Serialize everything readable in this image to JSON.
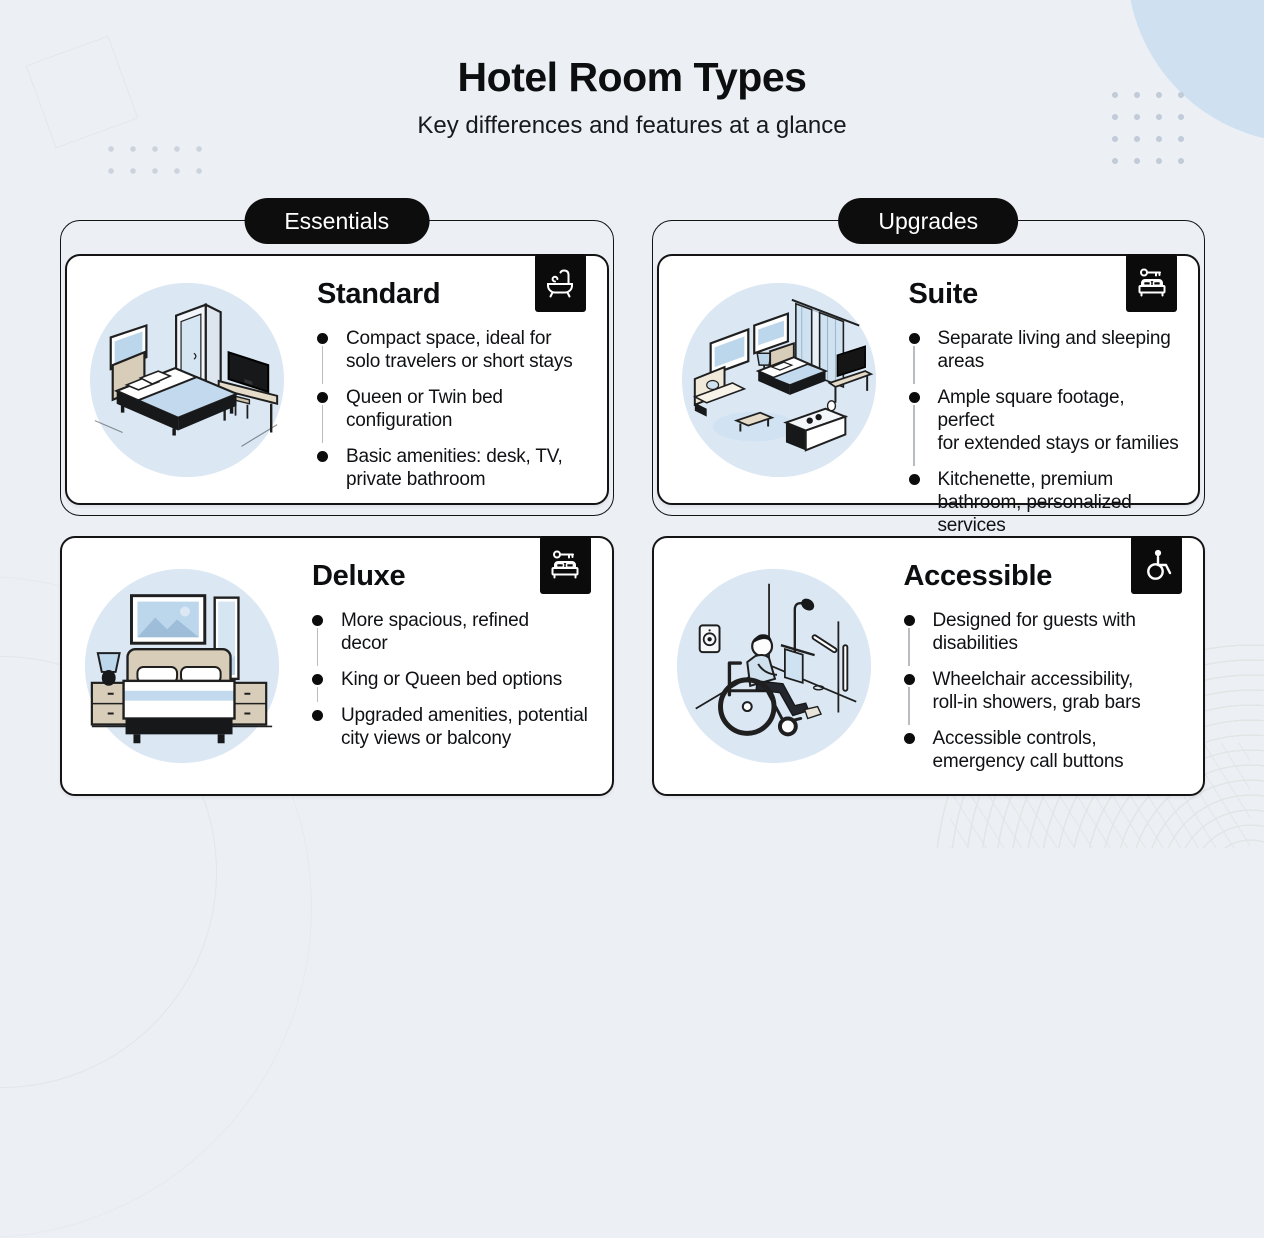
{
  "header": {
    "title": "Hotel Room Types",
    "subtitle": "Key differences and features at a glance"
  },
  "groups": [
    {
      "label": "Essentials"
    },
    {
      "label": "Upgrades"
    }
  ],
  "cards": [
    {
      "id": "standard",
      "title": "Standard",
      "icon": "bathtub-icon",
      "illustration": "isometric-standard-room",
      "bullets": [
        "Compact space, ideal for\nsolo travelers or short stays",
        "Queen or Twin bed\nconfiguration",
        "Basic amenities: desk, TV,\nprivate bathroom"
      ]
    },
    {
      "id": "deluxe",
      "title": "Deluxe",
      "icon": "key-bed-icon",
      "illustration": "deluxe-bedroom",
      "bullets": [
        "More spacious, refined\ndecor",
        "King or Queen bed options",
        "Upgraded amenities, potential\ncity views or balcony"
      ]
    },
    {
      "id": "suite",
      "title": "Suite",
      "icon": "key-bed-icon",
      "illustration": "isometric-suite-room",
      "bullets": [
        "Separate living and sleeping\nareas",
        "Ample square footage, perfect\nfor extended stays or families",
        "Kitchenette, premium\nbathroom, personalized\nservices"
      ]
    },
    {
      "id": "accessible",
      "title": "Accessible",
      "icon": "wheelchair-icon",
      "illustration": "accessible-bathroom",
      "bullets": [
        "Designed for guests with\ndisabilities",
        "Wheelchair accessibility,\nroll-in showers, grab bars",
        "Accessible controls,\nemergency call buttons"
      ]
    }
  ],
  "colors": {
    "page_background": "#ecf0f5",
    "card_background": "#ffffff",
    "border": "#141414",
    "pill_background": "#0d0d0d",
    "pill_text": "#ffffff",
    "badge_background": "#0b0b0b",
    "illustration_circle": "#dbe8f4",
    "accent_light_blue": "#c3d9ee",
    "text": "#101010"
  }
}
